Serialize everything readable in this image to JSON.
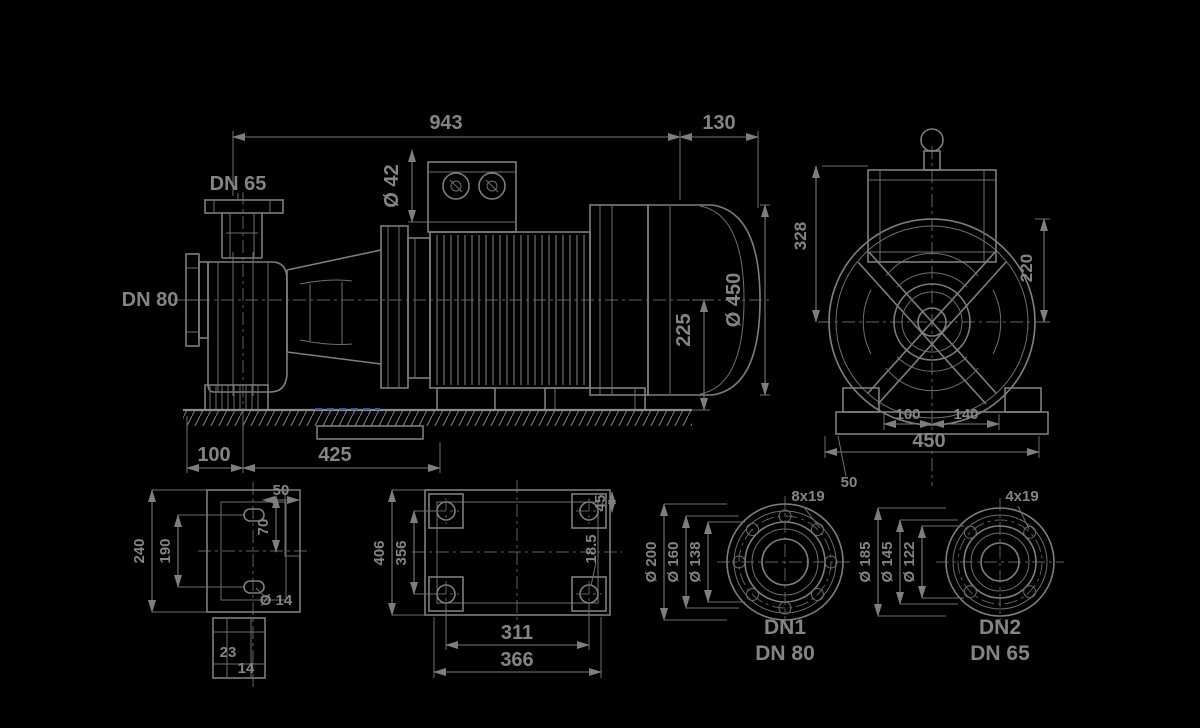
{
  "drawing": {
    "title": "pump-dimensional-drawing",
    "background_color": "#000000",
    "line_color": "#7e7e7e",
    "accent_blue": "#3c55a5",
    "side_view": {
      "overall_length": "943",
      "fan_clearance": "130",
      "shaft_dia": "Ø 42",
      "shaft_height": "225",
      "motor_dia": "Ø 450",
      "discharge_port": "DN 65",
      "suction_port": "DN 80",
      "foot_offset": "100",
      "foot_spacing": "425"
    },
    "end_view": {
      "top_height": "328",
      "upper_radius": "220",
      "rail_height": "50",
      "foot_left": "100",
      "foot_right": "140",
      "base_width": "450"
    },
    "pump_foot_view": {
      "outer_width": "240",
      "hole_spacing": "190",
      "depth": "50",
      "length": "70",
      "slot_length": "23",
      "slot_width": "14",
      "hole_dia": "Ø 14"
    },
    "baseplate_view": {
      "outer_width": "406",
      "hole_spacing_across": "356",
      "hole_spacing_long": "311",
      "outer_length": "366",
      "pad_size": "45",
      "hole_dia": "18.5"
    },
    "flange_1": {
      "bolts": "8x19",
      "outer_dia": "Ø 200",
      "bolt_circle_dia": "Ø 160",
      "raised_face_dia": "Ø 138",
      "port_id": "DN1",
      "port_size": "DN 80"
    },
    "flange_2": {
      "bolts": "4x19",
      "outer_dia": "Ø 185",
      "bolt_circle_dia": "Ø 145",
      "raised_face_dia": "Ø 122",
      "port_id": "DN2",
      "port_size": "DN 65"
    }
  }
}
